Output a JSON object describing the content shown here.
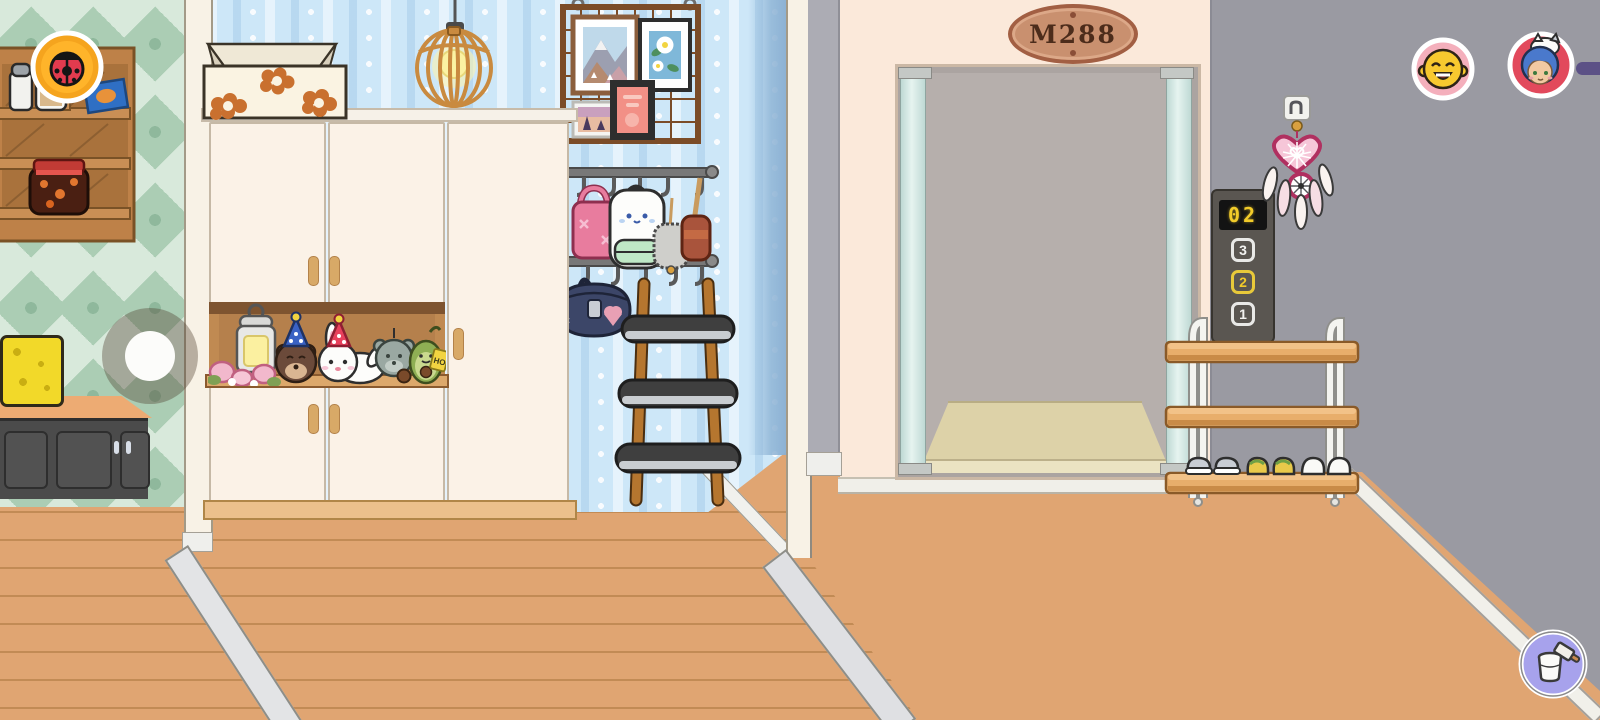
{
  "hud": {
    "ladybug_button": {
      "icon": "ladybug-icon"
    },
    "character_buttons": [
      {
        "icon": "laughing-face-avatar-icon"
      },
      {
        "icon": "blue-haired-kid-avatar-icon"
      }
    ],
    "paint_button": {
      "icon": "paint-bucket-icon"
    }
  },
  "elevator": {
    "plaque_label": "M288",
    "panel": {
      "display_value": "02",
      "buttons": [
        {
          "label": "3",
          "active": false
        },
        {
          "label": "2",
          "active": true
        },
        {
          "label": "1",
          "active": false
        }
      ]
    }
  },
  "decor": {
    "avocado_tag": "HOT"
  },
  "colors": {
    "floor": "#E0A572",
    "left_wall_diamond": "#ABCDB4",
    "hall_wall": "#CDE7F8",
    "elevator_wall": "#FBE9DA",
    "right_wall": "#9A9AA2",
    "active_floor_button": "#F2CB2A",
    "plaque": "#C9906F"
  }
}
